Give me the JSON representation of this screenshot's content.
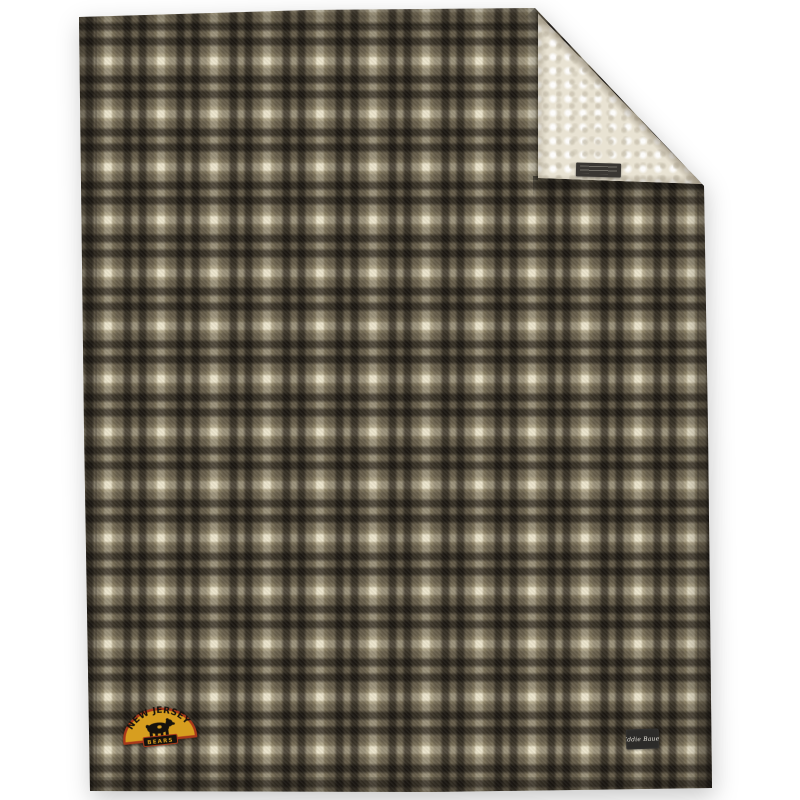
{
  "scene": {
    "type": "product-photo",
    "background_color": "#ffffff",
    "subject": "Gray plaid fleece throw blanket with folded corner showing cream sherpa lining"
  },
  "plaid": {
    "cream": "#ebe4cc",
    "light": "#c3beb1",
    "gray": "#6c6761",
    "dark": "#3a3630",
    "repeat_px": 53
  },
  "fleece": {
    "base": "#e9e3d3",
    "shade": "#c9c2b0"
  },
  "patch": {
    "arc_text": "NEW JERSEY",
    "banner_text": "BEARS",
    "gold": "#d79e1f",
    "border": "#a8381b",
    "ink": "#16120d"
  },
  "brand_tag": {
    "text": "Eddie Bauer",
    "bg": "#2c2b29",
    "fg": "#e6e3da"
  },
  "fold_label": {
    "bg": "#3a3733"
  }
}
